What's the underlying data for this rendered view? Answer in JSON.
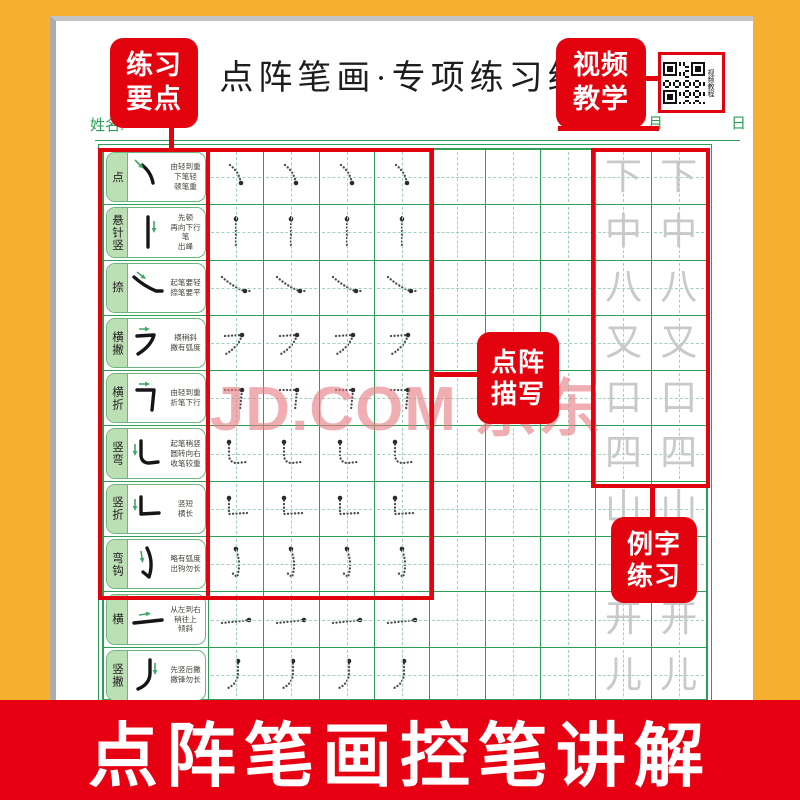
{
  "sheet": {
    "title": "点阵笔画·专项练习纸一",
    "name_label": "姓名:",
    "date": {
      "year": "年",
      "month": "月",
      "day": "日"
    }
  },
  "annotations": {
    "practice_points": "练习\n要点",
    "video_teaching": "视频\n教学",
    "dot_trace": "点阵\n描写",
    "example_practice": "例字\n练习",
    "qr_label": "视频教程",
    "qr_icon": "qr-code"
  },
  "watermark": "JD.COM 京东",
  "banner": {
    "text": "点阵笔画控笔讲解"
  },
  "colors": {
    "background_orange": "#F6AF2F",
    "accent_red": "#E2030F",
    "banner_red": "#E60012",
    "grid_green": "#2E9E57",
    "grid_dash_green": "#9ED3B8",
    "label_fill_green": "#BCDFB4",
    "watermark_pink": "#E98C91",
    "example_gray": "#C9C9C9"
  },
  "rows": [
    {
      "name": "点",
      "stroke": "dian",
      "desc": "由轻到重\n下笔轻\n顿笔重",
      "example": "下",
      "trace_cols": 4
    },
    {
      "name": "悬针竖",
      "stroke": "shu",
      "desc": "先顿\n再向下行笔\n出峰",
      "example": "中",
      "trace_cols": 4
    },
    {
      "name": "捺",
      "stroke": "na",
      "desc": "起笔要轻\n捺笔要平",
      "example": "八",
      "trace_cols": 4
    },
    {
      "name": "横撇",
      "stroke": "hengpie",
      "desc": "横稍斜\n撇有弧度",
      "example": "又",
      "trace_cols": 4
    },
    {
      "name": "横折",
      "stroke": "hengzhe",
      "desc": "由轻到重\n折笔下行",
      "example": "口",
      "trace_cols": 4
    },
    {
      "name": "竖弯",
      "stroke": "shuwan",
      "desc": "起笔稍竖\n圆转向右\n收笔较重",
      "example": "四",
      "trace_cols": 4
    },
    {
      "name": "竖折",
      "stroke": "shuzhe",
      "desc": "竖短\n横长",
      "example": "山",
      "trace_cols": 4
    },
    {
      "name": "弯钩",
      "stroke": "wangou",
      "desc": "略有弧度\n出钩勿长",
      "example": "",
      "trace_cols": 4
    },
    {
      "name": "横",
      "stroke": "heng",
      "desc": "从左到右\n稍往上\n倾斜",
      "example": "开",
      "trace_cols": 4
    },
    {
      "name": "竖撇",
      "stroke": "shupie",
      "desc": "先竖后撇\n撇锋勿长",
      "example": "儿",
      "trace_cols": 4
    }
  ]
}
